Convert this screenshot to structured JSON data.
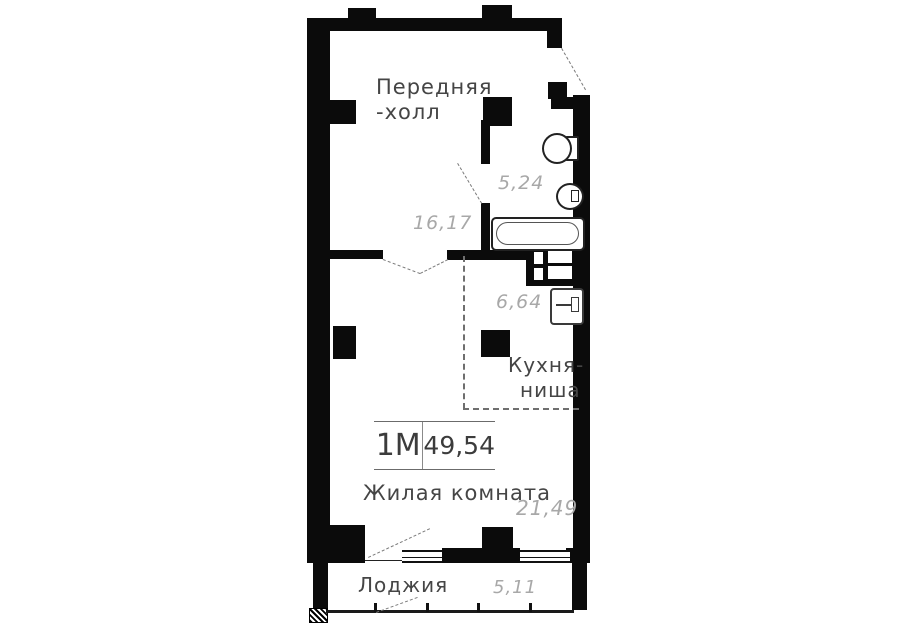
{
  "apartment": {
    "type": "1М",
    "total_area": "49,54"
  },
  "rooms": {
    "hall": {
      "name_line1": "Передняя",
      "name_line2": "-холл",
      "area": "16,17"
    },
    "bathroom": {
      "area": "5,24"
    },
    "kitchen_niche": {
      "name_line1": "Кухня-",
      "name_line2": "ниша",
      "area": "6,64"
    },
    "living_room": {
      "name": "Жилая комната",
      "area": "21,49"
    },
    "loggia": {
      "name": "Лоджия",
      "area": "5,11"
    }
  },
  "fixtures": {
    "toilet": "toilet-icon",
    "wash_basin": "sink-icon",
    "bathtub": "bathtub-icon",
    "kitchen_sink": "kitchen-sink-icon",
    "vent_shaft": "vent-shaft"
  },
  "colors": {
    "wall": "#0b0b0b",
    "background": "#ffffff",
    "area_text": "#a8a8a8",
    "name_text": "#454545",
    "dash": "#777777"
  }
}
